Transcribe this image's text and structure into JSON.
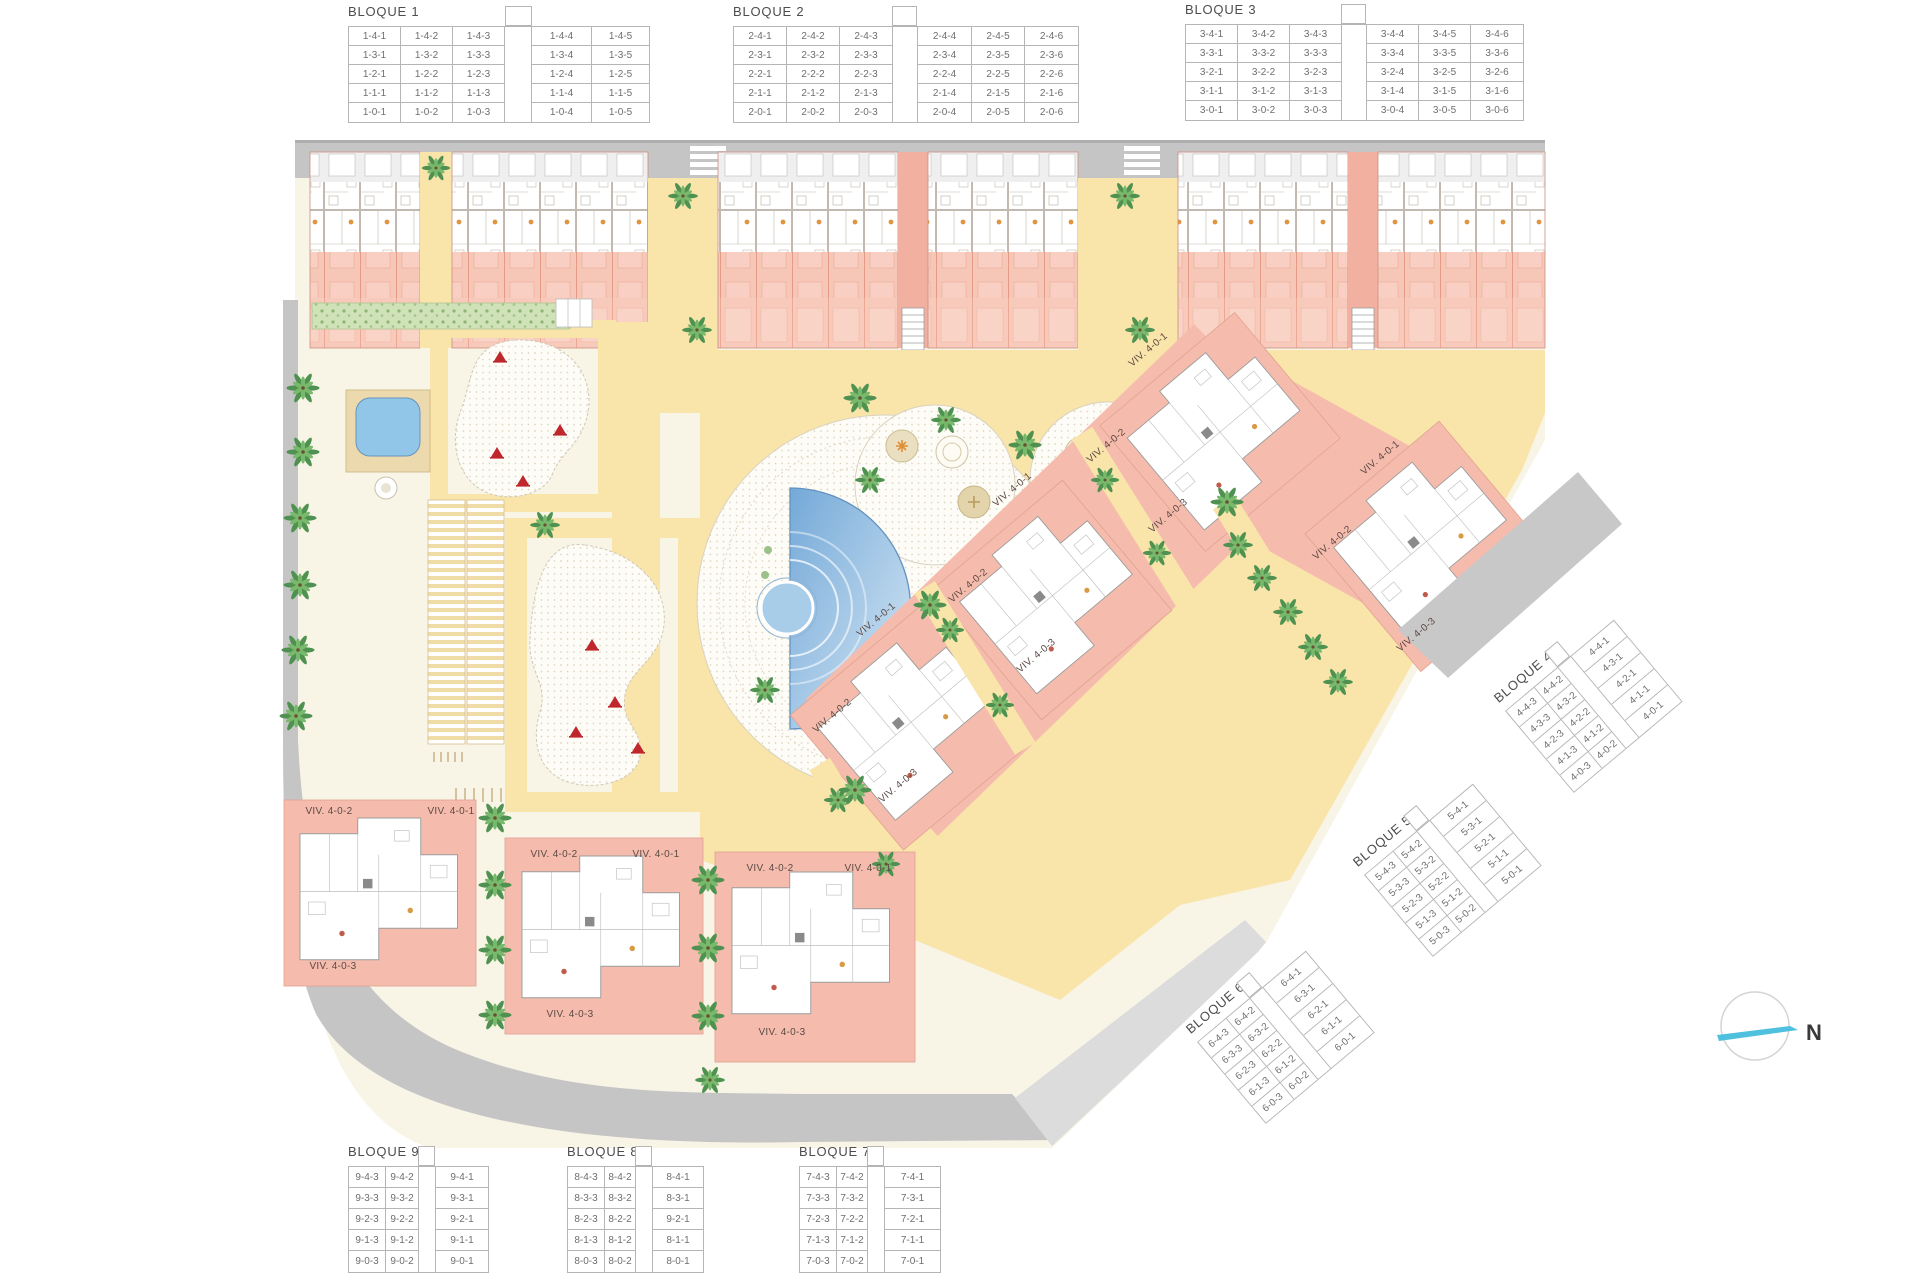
{
  "blocks": [
    {
      "title": "BLOQUE 1",
      "rows": [
        [
          "1-4-1",
          "1-4-2",
          "1-4-3",
          "",
          "1-4-4",
          "1-4-5"
        ],
        [
          "1-3-1",
          "1-3-2",
          "1-3-3",
          "",
          "1-3-4",
          "1-3-5"
        ],
        [
          "1-2-1",
          "1-2-2",
          "1-2-3",
          "",
          "1-2-4",
          "1-2-5"
        ],
        [
          "1-1-1",
          "1-1-2",
          "1-1-3",
          "",
          "1-1-4",
          "1-1-5"
        ],
        [
          "1-0-1",
          "1-0-2",
          "1-0-3",
          "",
          "1-0-4",
          "1-0-5"
        ]
      ]
    },
    {
      "title": "BLOQUE 2",
      "rows": [
        [
          "2-4-1",
          "2-4-2",
          "2-4-3",
          "",
          "2-4-4",
          "2-4-5",
          "2-4-6"
        ],
        [
          "2-3-1",
          "2-3-2",
          "2-3-3",
          "",
          "2-3-4",
          "2-3-5",
          "2-3-6"
        ],
        [
          "2-2-1",
          "2-2-2",
          "2-2-3",
          "",
          "2-2-4",
          "2-2-5",
          "2-2-6"
        ],
        [
          "2-1-1",
          "2-1-2",
          "2-1-3",
          "",
          "2-1-4",
          "2-1-5",
          "2-1-6"
        ],
        [
          "2-0-1",
          "2-0-2",
          "2-0-3",
          "",
          "2-0-4",
          "2-0-5",
          "2-0-6"
        ]
      ]
    },
    {
      "title": "BLOQUE 3",
      "rows": [
        [
          "3-4-1",
          "3-4-2",
          "3-4-3",
          "",
          "3-4-4",
          "3-4-5",
          "3-4-6"
        ],
        [
          "3-3-1",
          "3-3-2",
          "3-3-3",
          "",
          "3-3-4",
          "3-3-5",
          "3-3-6"
        ],
        [
          "3-2-1",
          "3-2-2",
          "3-2-3",
          "",
          "3-2-4",
          "3-2-5",
          "3-2-6"
        ],
        [
          "3-1-1",
          "3-1-2",
          "3-1-3",
          "",
          "3-1-4",
          "3-1-5",
          "3-1-6"
        ],
        [
          "3-0-1",
          "3-0-2",
          "3-0-3",
          "",
          "3-0-4",
          "3-0-5",
          "3-0-6"
        ]
      ]
    },
    {
      "title": "BLOQUE 4",
      "rows": [
        [
          "4-4-3",
          "4-4-2",
          "",
          "4-4-1"
        ],
        [
          "4-3-3",
          "4-3-2",
          "",
          "4-3-1"
        ],
        [
          "4-2-3",
          "4-2-2",
          "",
          "4-2-1"
        ],
        [
          "4-1-3",
          "4-1-2",
          "",
          "4-1-1"
        ],
        [
          "4-0-3",
          "4-0-2",
          "",
          "4-0-1"
        ]
      ]
    },
    {
      "title": "BLOQUE 5",
      "rows": [
        [
          "5-4-3",
          "5-4-2",
          "",
          "5-4-1"
        ],
        [
          "5-3-3",
          "5-3-2",
          "",
          "5-3-1"
        ],
        [
          "5-2-3",
          "5-2-2",
          "",
          "5-2-1"
        ],
        [
          "5-1-3",
          "5-1-2",
          "",
          "5-1-1"
        ],
        [
          "5-0-3",
          "5-0-2",
          "",
          "5-0-1"
        ]
      ]
    },
    {
      "title": "BLOQUE 6",
      "rows": [
        [
          "6-4-3",
          "6-4-2",
          "",
          "6-4-1"
        ],
        [
          "6-3-3",
          "6-3-2",
          "",
          "6-3-1"
        ],
        [
          "6-2-3",
          "6-2-2",
          "",
          "6-2-1"
        ],
        [
          "6-1-3",
          "6-1-2",
          "",
          "6-1-1"
        ],
        [
          "6-0-3",
          "6-0-2",
          "",
          "6-0-1"
        ]
      ]
    },
    {
      "title": "BLOQUE 7",
      "rows": [
        [
          "7-4-3",
          "7-4-2",
          "",
          "7-4-1"
        ],
        [
          "7-3-3",
          "7-3-2",
          "",
          "7-3-1"
        ],
        [
          "7-2-3",
          "7-2-2",
          "",
          "7-2-1"
        ],
        [
          "7-1-3",
          "7-1-2",
          "",
          "7-1-1"
        ],
        [
          "7-0-3",
          "7-0-2",
          "",
          "7-0-1"
        ]
      ]
    },
    {
      "title": "BLOQUE 8",
      "rows": [
        [
          "8-4-3",
          "8-4-2",
          "",
          "8-4-1"
        ],
        [
          "8-3-3",
          "8-3-2",
          "",
          "8-3-1"
        ],
        [
          "8-2-3",
          "8-2-2",
          "",
          "9-2-1"
        ],
        [
          "8-1-3",
          "8-1-2",
          "",
          "8-1-1"
        ],
        [
          "8-0-3",
          "8-0-2",
          "",
          "8-0-1"
        ]
      ]
    },
    {
      "title": "BLOQUE 9",
      "rows": [
        [
          "9-4-3",
          "9-4-2",
          "",
          "9-4-1"
        ],
        [
          "9-3-3",
          "9-3-2",
          "",
          "9-3-1"
        ],
        [
          "9-2-3",
          "9-2-2",
          "",
          "9-2-1"
        ],
        [
          "9-1-3",
          "9-1-2",
          "",
          "9-1-1"
        ],
        [
          "9-0-3",
          "9-0-2",
          "",
          "9-0-1"
        ]
      ]
    }
  ],
  "clusters": [
    {
      "name": "bottom-cluster-block9",
      "labels": [
        "VIV. 4-0-1",
        "VIV. 4-0-2",
        "VIV. 4-0-3"
      ]
    },
    {
      "name": "bottom-cluster-block8",
      "labels": [
        "VIV. 4-0-1",
        "VIV. 4-0-2",
        "VIV. 4-0-3"
      ]
    },
    {
      "name": "bottom-cluster-block7",
      "labels": [
        "VIV. 4-0-1",
        "VIV. 4-0-2",
        "VIV. 4-0-3"
      ]
    },
    {
      "name": "diagonal-cluster-1",
      "labels": [
        "VIV. 4-0-1",
        "VIV. 4-0-2",
        "VIV. 4-0-3"
      ]
    },
    {
      "name": "diagonal-cluster-2",
      "labels": [
        "VIV. 4-0-1",
        "VIV. 4-0-2",
        "VIV. 4-0-3"
      ]
    },
    {
      "name": "diagonal-cluster-3",
      "labels": [
        "VIV. 4-0-1",
        "VIV. 4-0-2",
        "VIV. 4-0-3"
      ]
    },
    {
      "name": "diagonal-cluster-4",
      "labels": [
        "VIV. 4-0-1",
        "VIV. 4-0-2",
        "VIV. 4-0-3"
      ]
    }
  ],
  "compass": {
    "label": "N"
  },
  "colors": {
    "building_salmon": "#f2b0a0",
    "terrace_salmon": "#f6c6b7",
    "cluster_pink": "#f5bcad",
    "path_yellow": "#f9e4aa",
    "road_gray": "#c5c5c5",
    "cream": "#f8f4e6",
    "pool_blue": "#74a9d8",
    "palm_green": "#5da054",
    "play_red": "#c0272d",
    "compass_cyan": "#4fc0dd"
  }
}
